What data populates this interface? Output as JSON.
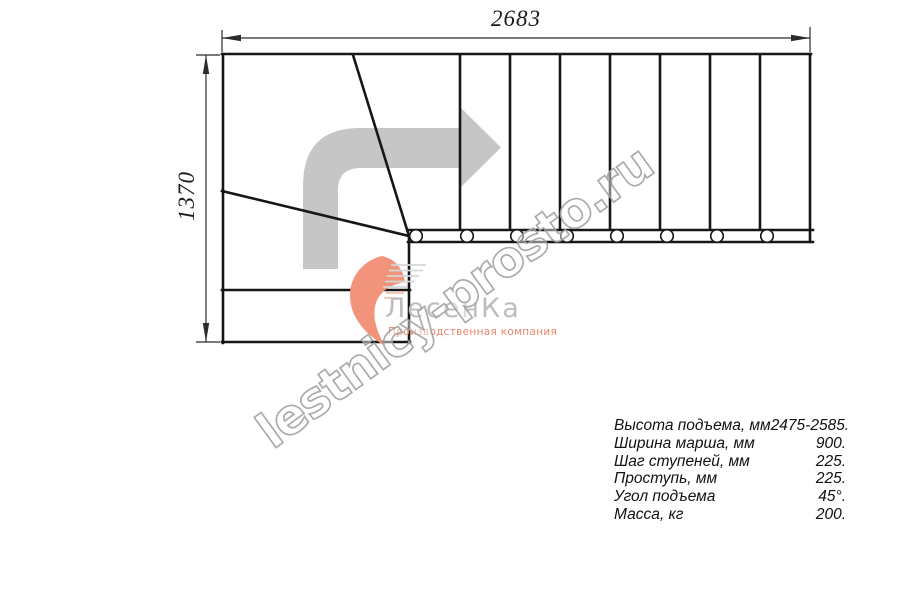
{
  "drawing": {
    "dim_width_label": "2683",
    "dim_height_label": "1370",
    "treads_count": 8,
    "direction": "turn-left-then-right-run"
  },
  "watermark": {
    "text": "lestnicy-prosto.ru"
  },
  "logo": {
    "brand": "ЛесенКа",
    "tagline": "Производственная компания"
  },
  "specs": {
    "rows": [
      {
        "label": "Высота подъема, мм",
        "value": "2475-2585."
      },
      {
        "label": "Ширина марша, мм",
        "value": "900."
      },
      {
        "label": "Шаг ступеней, мм",
        "value": "225."
      },
      {
        "label": "Проступь, мм",
        "value": "225."
      },
      {
        "label": "Угол подъема",
        "value": "45°."
      },
      {
        "label": "Масса, кг",
        "value": "200."
      }
    ]
  },
  "colors": {
    "plan_line": "#161616",
    "dimension_line": "#2b2b2b",
    "direction_arrow": "#c6c6c6",
    "logo_accent": "#f2947c",
    "logo_text": "#bdbdbd",
    "logo_tagline": "#e8876c",
    "watermark_stroke": "#a3a3a3"
  }
}
